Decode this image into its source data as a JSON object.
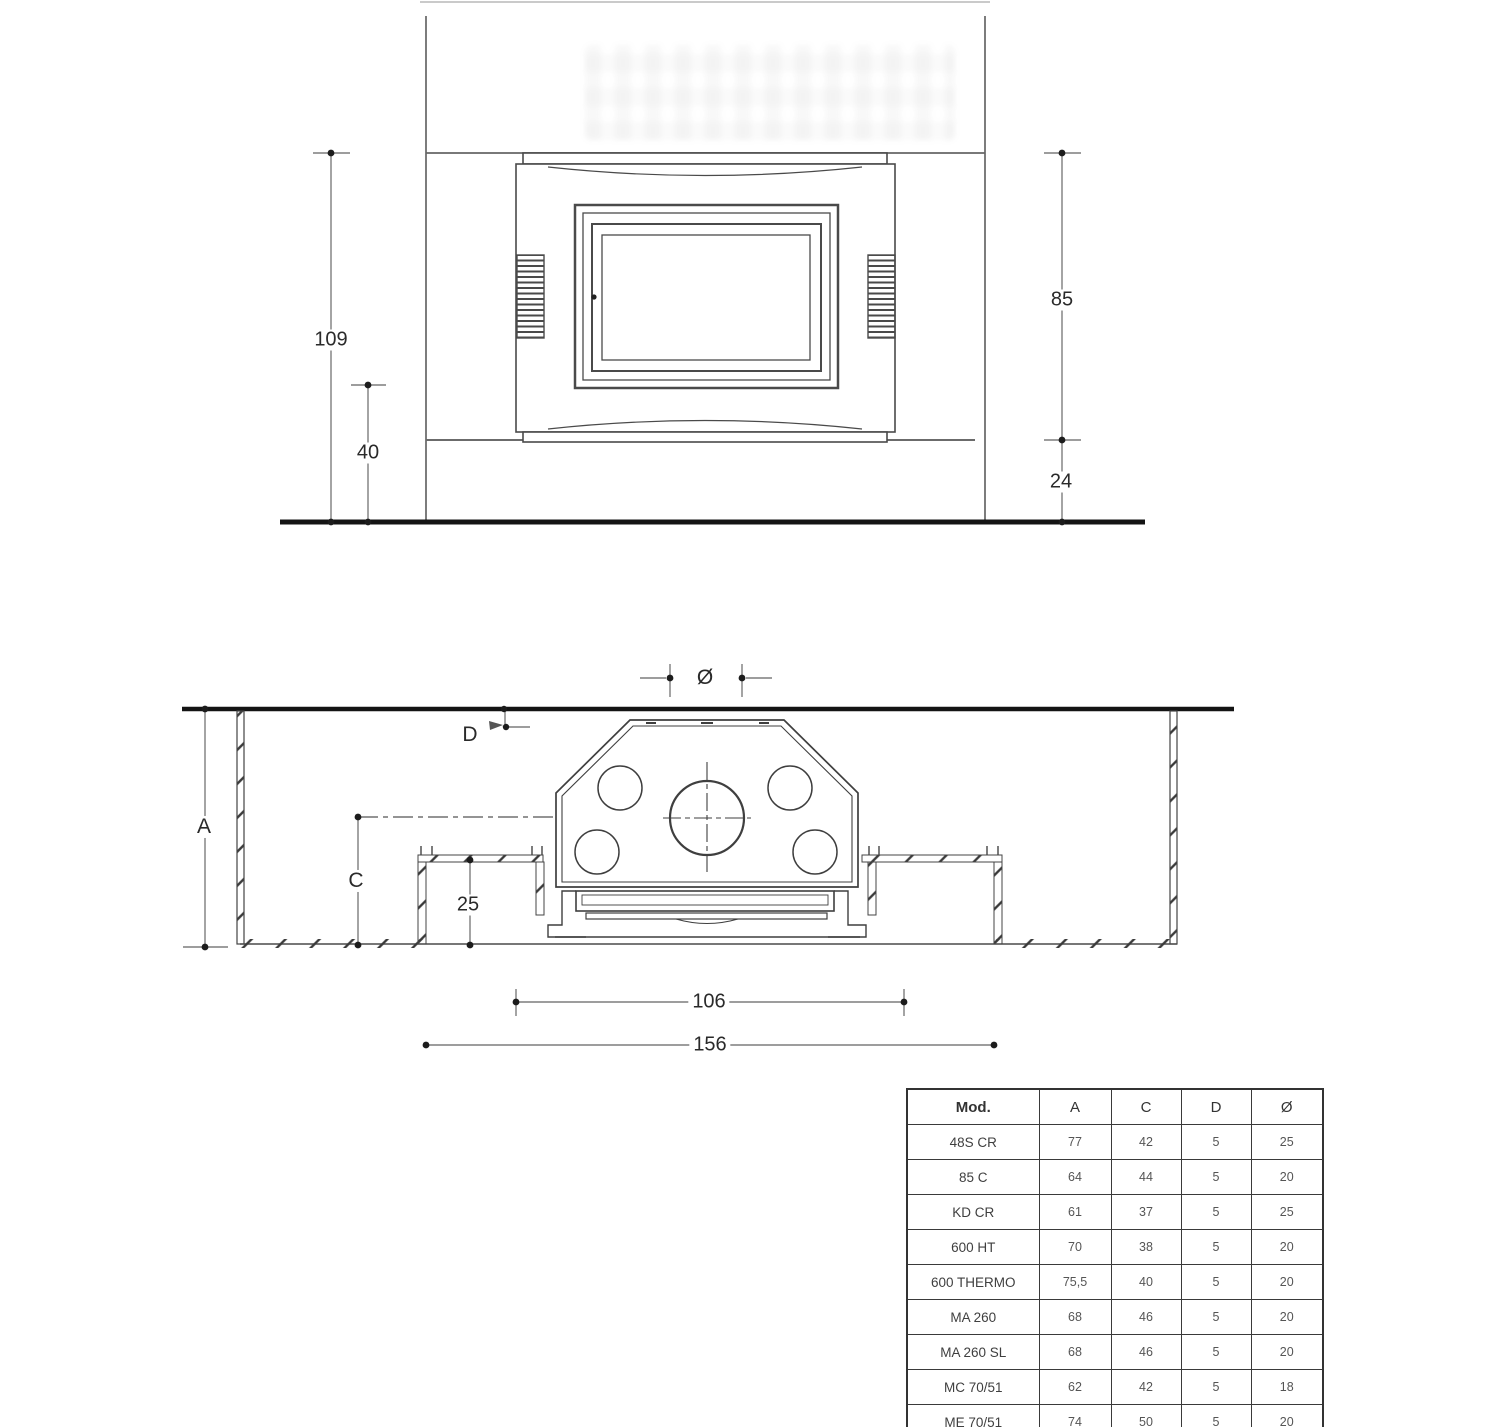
{
  "front_view": {
    "dim_total_height": "109",
    "dim_hearth_height": "40",
    "dim_insert_height": "85",
    "dim_base_height": "24"
  },
  "plan_view": {
    "dim_flue_diameter": "Ø",
    "dim_wall_distance": "D",
    "dim_depth_a": "A",
    "dim_depth_c": "C",
    "dim_bench_depth": "25",
    "dim_inner_width": "106",
    "dim_overall_width": "156"
  },
  "spec_table": {
    "headers": {
      "model": "Mod.",
      "a": "A",
      "c": "C",
      "d": "D",
      "diameter": "Ø"
    },
    "rows": [
      {
        "model": "48S CR",
        "a": "77",
        "c": "42",
        "d": "5",
        "diameter": "25"
      },
      {
        "model": "85 C",
        "a": "64",
        "c": "44",
        "d": "5",
        "diameter": "20"
      },
      {
        "model": "KD CR",
        "a": "61",
        "c": "37",
        "d": "5",
        "diameter": "25"
      },
      {
        "model": "600 HT",
        "a": "70",
        "c": "38",
        "d": "5",
        "diameter": "20"
      },
      {
        "model": "600 THERMO",
        "a": "75,5",
        "c": "40",
        "d": "5",
        "diameter": "20"
      },
      {
        "model": "MA 260",
        "a": "68",
        "c": "46",
        "d": "5",
        "diameter": "20"
      },
      {
        "model": "MA 260 SL",
        "a": "68",
        "c": "46",
        "d": "5",
        "diameter": "20"
      },
      {
        "model": "MC 70/51",
        "a": "62",
        "c": "42",
        "d": "5",
        "diameter": "18"
      },
      {
        "model": "ME 70/51",
        "a": "74",
        "c": "50",
        "d": "5",
        "diameter": "20"
      }
    ]
  },
  "colors": {
    "line": "#4a4a4a",
    "structure": "#666666",
    "dim_line": "#7d7d7d",
    "thick": "#141414",
    "table_border": "#3a3a3a"
  }
}
